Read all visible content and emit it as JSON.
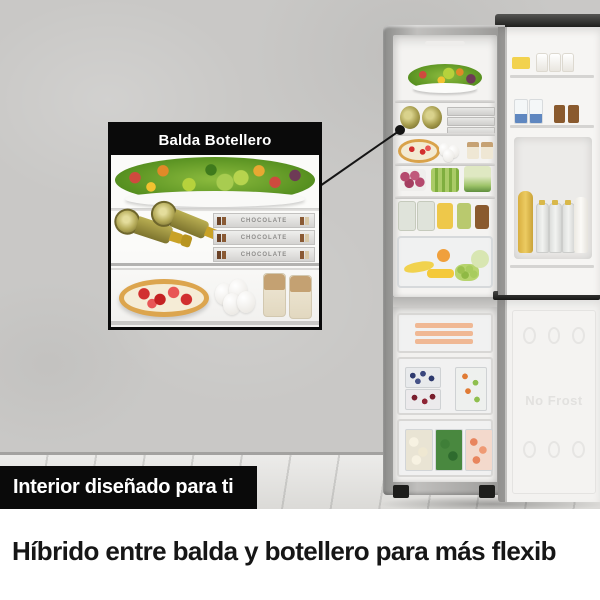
{
  "colors": {
    "wall": "#c9c8c6",
    "floor": "#e2e1de",
    "black": "#0a0a0a",
    "white_band": "#ffffff",
    "fridge_silver": "#a9a9a7",
    "interior": "#f4f3f1",
    "headline_text": "#161616"
  },
  "callout": {
    "title": "Balda Botellero",
    "chocolate_boxes": [
      {
        "label": "CHOCOLATE"
      },
      {
        "label": "CHOCOLATE"
      },
      {
        "label": "CHOCOLATE"
      }
    ]
  },
  "fridge": {
    "freezer_door_embossing": "No Frost"
  },
  "caption_bar": {
    "text": "Interior diseñado para ti"
  },
  "headline": {
    "text": "Híbrido entre balda y botellero para más flexib"
  }
}
